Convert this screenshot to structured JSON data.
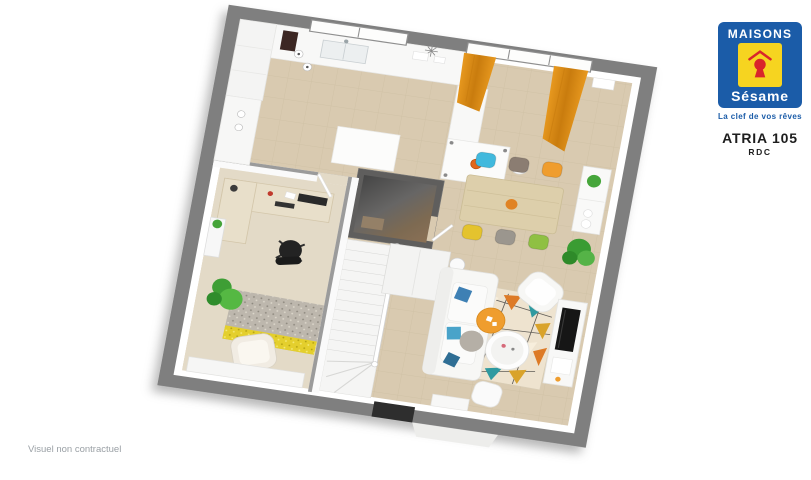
{
  "branding": {
    "brand_name_top": "MAISONS",
    "brand_name_script": "Sésame",
    "tagline": "La clef de vos rêves",
    "logo_icon": "keyhole-icon"
  },
  "plan_label": {
    "model": "ATRIA 105",
    "level": "RDC"
  },
  "footer": {
    "disclaimer": "Visuel non contractuel"
  },
  "colors": {
    "brand-blue": "#1b5ca8",
    "brand-yellow": "#f6d420",
    "brand-red": "#d9252b",
    "wall-outer": "#7f7f7f",
    "wall-dark": "#5f5e5d",
    "floor-tile": "#d9cab0",
    "floor-grout": "#c9bb9e",
    "floor-carpet": "#e3dac7",
    "curtain": "#e8991f",
    "curtain-dark": "#c97c0e",
    "table-wood": "#ddcfab",
    "desk-wood": "#e8dfca",
    "rug-teal": "#2f9aa0",
    "rug-orange": "#dd7a26",
    "rug-mustard": "#d9a32b",
    "rug-base": "#eee3cf",
    "plant-green": "#44a338",
    "accent-orange": "#ef9d2e",
    "sofa-white": "#f7f7f5",
    "tv-black": "#161616",
    "text-dark": "#1d1d1d",
    "text-gray": "#9aa0a5"
  },
  "plan": {
    "view": "3d-top-down-floorplan",
    "rotation_deg": 8.3,
    "rooms": [
      "kitchen",
      "dining-area",
      "living-room",
      "office",
      "wc",
      "staircase",
      "entrance-hall"
    ],
    "dining_chairs": [
      "#41b9dd",
      "#8b7d72",
      "#ef9d2e",
      "#e4c32e",
      "#9b968e",
      "#8fc043"
    ]
  }
}
